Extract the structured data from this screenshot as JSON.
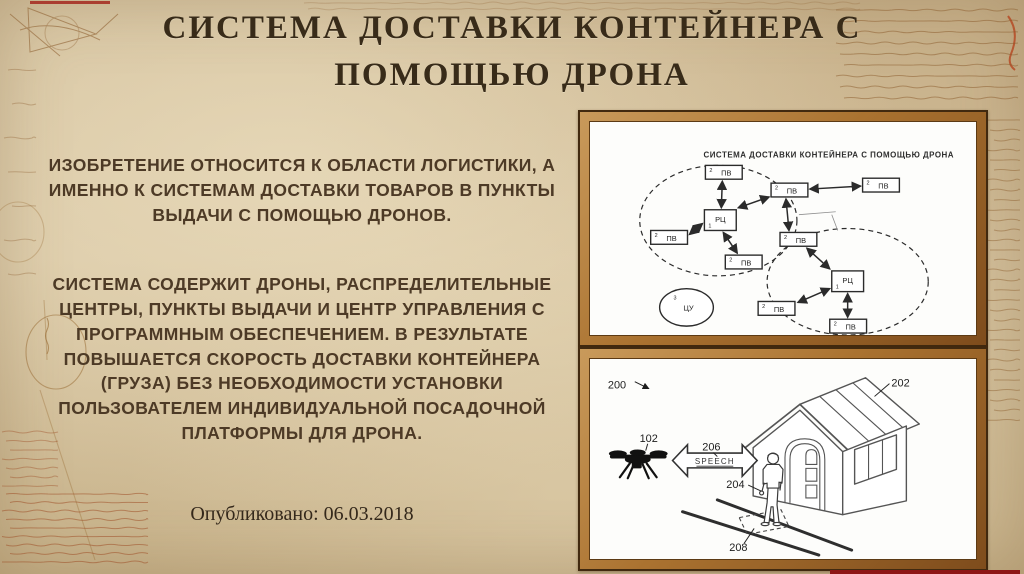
{
  "slide": {
    "title": "СИСТЕМА ДОСТАВКИ КОНТЕЙНЕРА С\nПОМОЩЬЮ ДРОНА",
    "paragraph1": "ИЗОБРЕТЕНИЕ ОТНОСИТСЯ К ОБЛАСТИ ЛОГИСТИКИ, А ИМЕННО К СИСТЕМАМ ДОСТАВКИ ТОВАРОВ В ПУНКТЫ ВЫДАЧИ С ПОМОЩЬЮ ДРОНОВ.",
    "paragraph2": "СИСТЕМА СОДЕРЖИТ ДРОНЫ, РАСПРЕДЕЛИТЕЛЬНЫЕ ЦЕНТРЫ, ПУНКТЫ ВЫДАЧИ И ЦЕНТР УПРАВЛЕНИЯ С ПРОГРАММНЫМ ОБЕСПЕЧЕНИЕМ. В РЕЗУЛЬТАТЕ ПОВЫШАЕТСЯ СКОРОСТЬ ДОСТАВКИ КОНТЕЙНЕРА (ГРУЗА) БЕЗ НЕОБХОДИМОСТИ УСТАНОВКИ ПОЛЬЗОВАТЕЛЕМ ИНДИВИДУАЛЬНОЙ ПОСАДОЧНОЙ ПЛАТФОРМЫ ДЛЯ ДРОНА.",
    "published": "Опубликовано: 06.03.2018"
  },
  "network_diagram": {
    "title": "СИСТЕМА ДОСТАВКИ КОНТЕЙНЕРА С ПОМОЩЬЮ ДРОНА",
    "labels": {
      "pv": "ПВ",
      "rc": "РЦ",
      "cu": "ЦУ"
    },
    "refs": {
      "pv": "2",
      "rc": "1",
      "cu": "3"
    }
  },
  "patent_figure": {
    "figure_ref": "200",
    "drone_ref": "102",
    "house_ref": "202",
    "person_ref": "204",
    "speech_ref": "206",
    "speech_label": "SPEECH",
    "platform_ref": "208"
  },
  "colors": {
    "parchment": "#d2bf9b",
    "title_text": "#382b19",
    "body_text": "#4d3a26",
    "frame_copper": "#aa7230",
    "frame_outline": "#41290f",
    "sketch_ink": "#8a5a2a",
    "sketch_red_ink": "#9c4820",
    "accent_red": "#8d1616",
    "diagram_paper": "#fdfdfb",
    "diagram_ink": "#2b2b2b"
  }
}
